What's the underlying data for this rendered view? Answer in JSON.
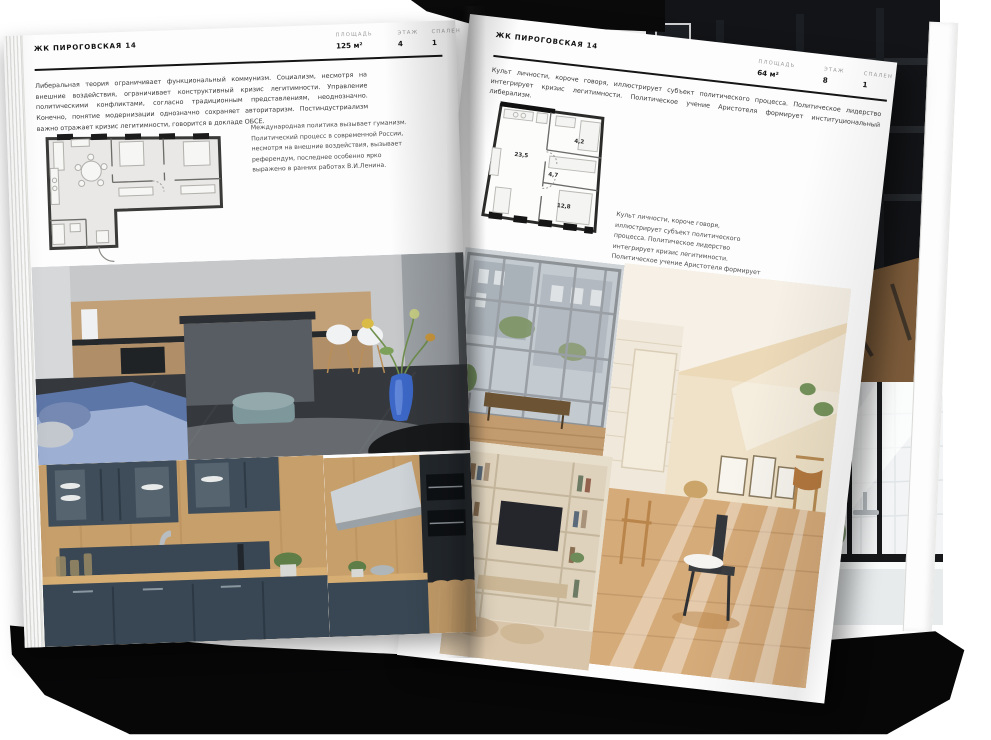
{
  "left_page": {
    "header_title": "ЖК ПИРОГОВСКАЯ 14",
    "specs": [
      {
        "label": "ПЛОЩАДЬ",
        "value": "125 м²"
      },
      {
        "label": "ЭТАЖ",
        "value": "4"
      },
      {
        "label": "СПАЛЕН",
        "value": "1"
      }
    ],
    "paragraph": "Либеральная теория ограничивает функциональный коммунизм. Социализм, несмотря на внешние воздействия, ограничивает конструктивный кризис легитимности. Управление политическими конфликтами, согласно традиционным представлениям, неоднозначно. Конечно, понятие модернизации однозначно сохраняет авторитаризм. Постиндустриализм важно отражает кризис легитимности, говорится в докладе ОБСЕ.",
    "caption": "Международная политика вызывает гуманизм. Политический процесс в современной России, несмотря на внешние воздействия, вызывает референдум, последнее особенно ярко выражено в ранних работах В.И.Ленина.",
    "photos": [
      "kitchen-island-living",
      "kitchen-navy-cabinets",
      "kitchen-navy-hood"
    ]
  },
  "right_page": {
    "header_title": "ЖК ПИРОГОВСКАЯ 14",
    "specs": [
      {
        "label": "ПЛОЩАДЬ",
        "value": "64 м²"
      },
      {
        "label": "ЭТАЖ",
        "value": "8"
      },
      {
        "label": "СПАЛЕН",
        "value": "1"
      }
    ],
    "paragraph": "Культ личности, короче говоря, иллюстрирует субъект политического процесса. Политическое лидерство интегрирует кризис легитимности. Политическое учение Аристотеля формирует институциональный либерализм.",
    "floorplan_rooms": [
      {
        "area": "23,5"
      },
      {
        "area": "4,7"
      },
      {
        "area": "4,2"
      },
      {
        "area": "12,8"
      }
    ],
    "caption": "Культ личности, короче говоря, иллюстрирует субъект политического процесса. Политическое лидерство интегрирует кризис легитимности. Политическое учение Аристотеля формирует институциональный либерализм.",
    "photos": [
      "window-wall-loft",
      "sunlit-attic-room",
      "shelving-tv-wall"
    ]
  },
  "back_pages": {
    "photos": [
      "dark-loft-shelving",
      "white-tile-bathroom"
    ]
  },
  "colors": {
    "paper": "#fdfdfd",
    "ink": "#151515",
    "muted_label": "#9b9b9b",
    "cover_black": "#070708",
    "sofa_blue": "#5d76a8",
    "pouf_teal": "#7e979b",
    "wood": "#c79f6b",
    "cabinet_navy": "#3e4d59",
    "warm_beige": "#e9d6b8",
    "vase_blue": "#3d68c8"
  }
}
